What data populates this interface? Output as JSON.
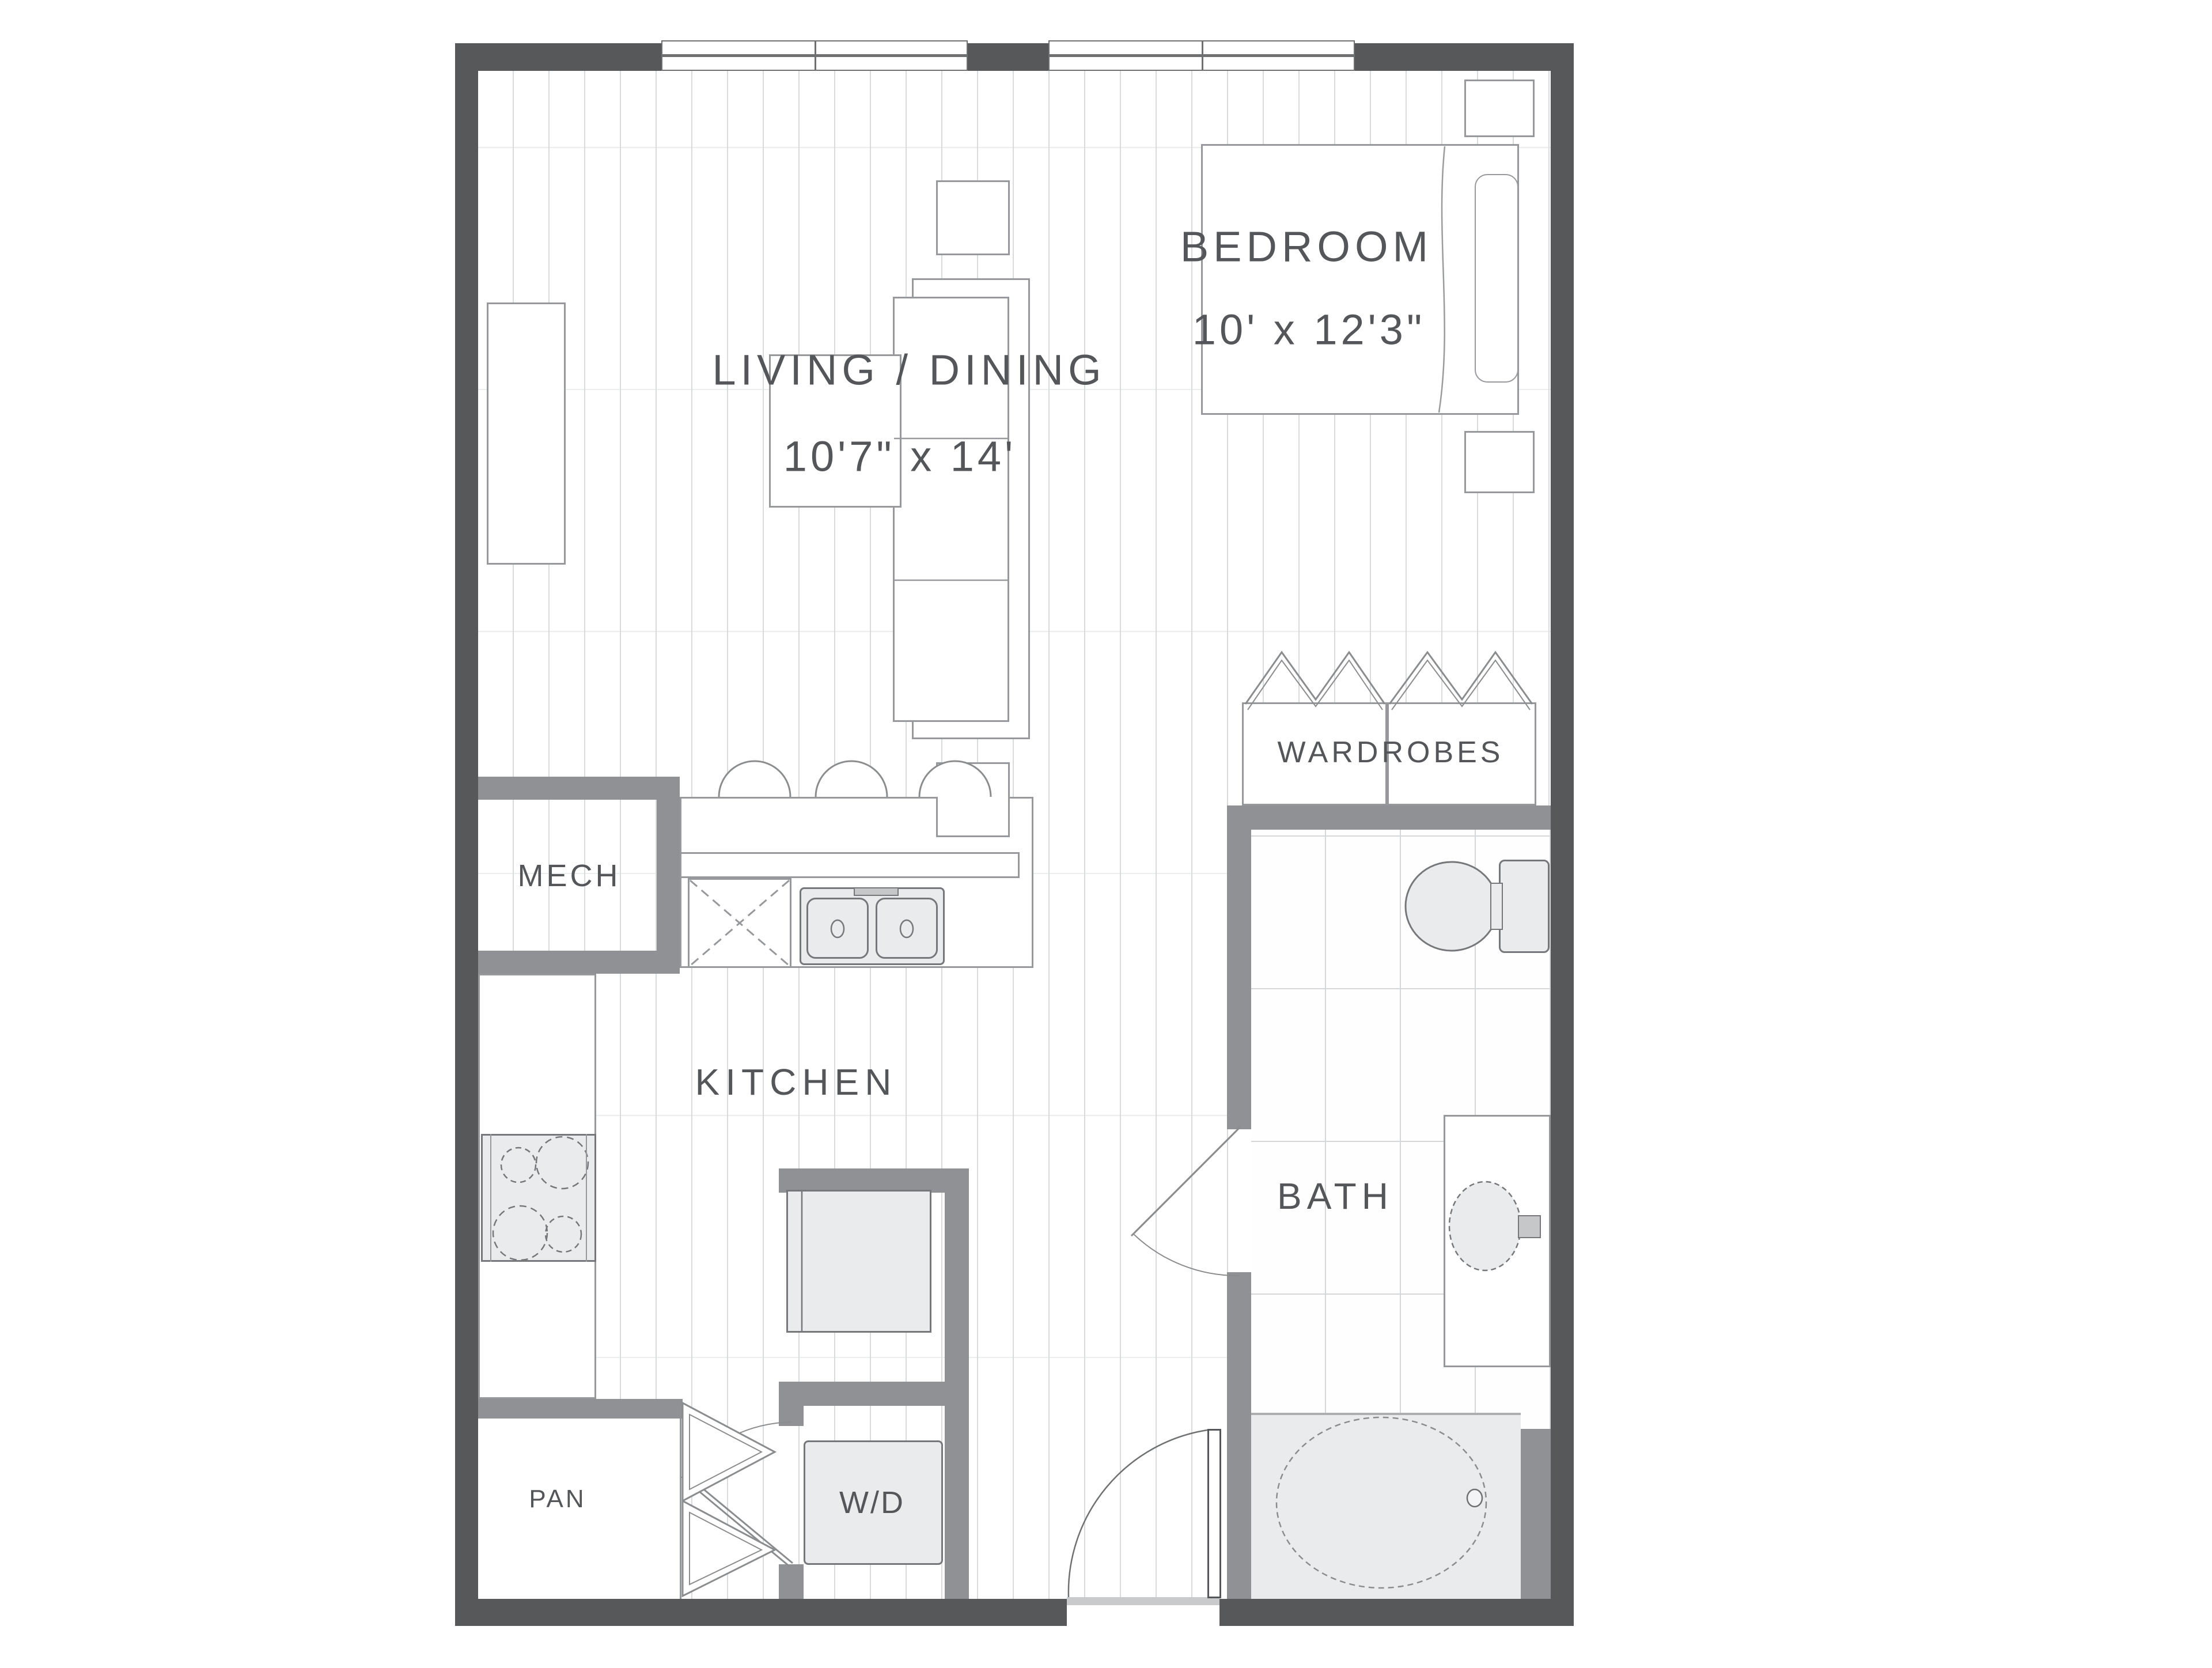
{
  "labels": {
    "living": {
      "name": "LIVING / DINING",
      "dims": "10'7\" x 14'"
    },
    "bedroom": {
      "name": "BEDROOM",
      "dims": "10' x 12'3\""
    },
    "kitchen": {
      "name": "KITCHEN"
    },
    "bath": {
      "name": "BATH"
    },
    "mech": {
      "name": "MECH"
    },
    "pantry": {
      "name": "PAN"
    },
    "laundry": {
      "name": "W/D"
    },
    "wardrobes": {
      "name": "WARDROBES"
    }
  },
  "colors": {
    "outer_wall": "#57585a",
    "inner_wall": "#909194",
    "fixture_fill": "#e9ebec",
    "fixture_border": "#76777a",
    "furniture_border": "#97989b",
    "floor_line": "#d9dadc",
    "tile_line": "#d4d6d8",
    "text": "#55565a"
  }
}
